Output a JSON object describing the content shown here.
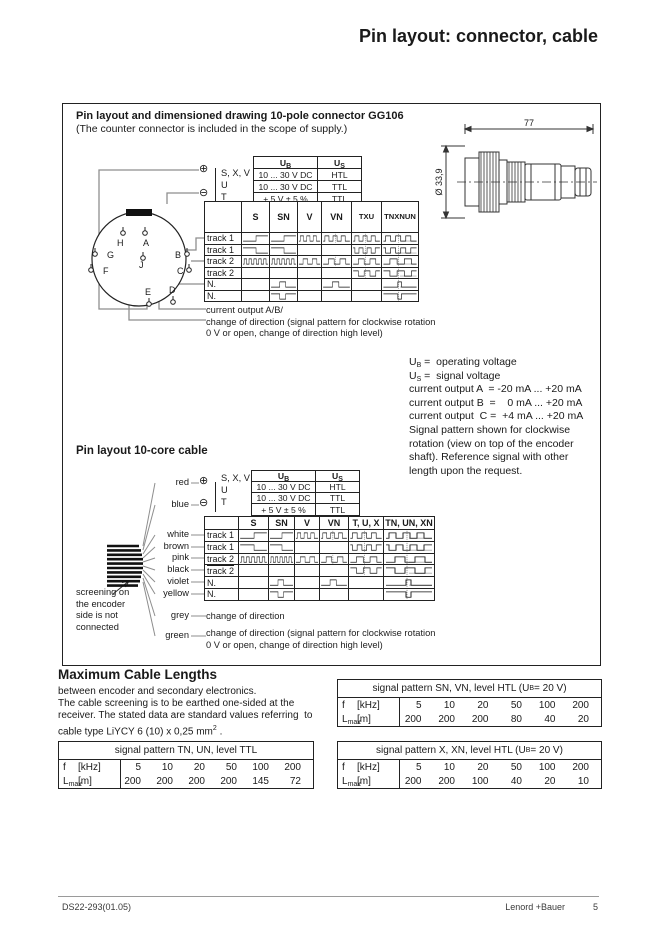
{
  "title": "Pin layout: connector, cable",
  "connector": {
    "heading": "Pin layout and dimensioned drawing 10-pole connector GG106",
    "subheading": "(The counter connector is included in the scope of supply.)",
    "dim_length": "77",
    "dim_diameter": "Ø 33,9",
    "pins": [
      "H",
      "A",
      "G",
      "B",
      "F",
      "C",
      "E",
      "D",
      "J"
    ],
    "terminal_plus": "⊕",
    "terminal_minus": "⊖",
    "power_labels": [
      "S, X, V",
      "U",
      "T"
    ],
    "power_header": [
      {
        "pre": "U",
        "sub": "B"
      },
      {
        "pre": "U",
        "sub": "S"
      }
    ],
    "power_rows": [
      [
        "10 ... 30 V DC",
        "HTL"
      ],
      [
        "10 ... 30 V DC",
        "TTL"
      ],
      [
        "+ 5 V ± 5 %",
        "TTL"
      ]
    ],
    "signal_columns": [
      "S",
      "SN",
      "V",
      "VN",
      [
        "T",
        "X",
        "U"
      ],
      [
        "TN",
        "XN",
        "UN"
      ]
    ],
    "signal_rows": [
      {
        "label": "track 1",
        "over": false,
        "waves": [
          "rise",
          "rise",
          "sq3",
          "sq3 d",
          "sq3 d",
          "sq3 d g"
        ]
      },
      {
        "label": "track 1",
        "over": true,
        "waves": [
          "fall",
          "fall",
          "",
          "",
          "sq3i d",
          "sq3i d g"
        ]
      },
      {
        "label": "track 2",
        "over": false,
        "waves": [
          "sq5",
          "sq5",
          "sq2",
          "sq2 d",
          "sq2 d",
          "sq2 d g"
        ]
      },
      {
        "label": "track 2",
        "over": true,
        "waves": [
          "",
          "",
          "",
          "",
          "sq2i d",
          "sq2i d g"
        ]
      },
      {
        "label": "N.",
        "over": false,
        "waves": [
          "",
          "pulse",
          "",
          "pulse",
          "",
          "npulse d g"
        ]
      },
      {
        "label": "N.",
        "over": true,
        "waves": [
          "",
          "pulsei",
          "",
          "",
          "",
          "npulsei d"
        ]
      }
    ],
    "notes": [
      "current output A/B/",
      "change of direction (signal pattern for clockwise rotation",
      "0 V or open, change of direction high level)"
    ]
  },
  "legend": {
    "lines": [
      {
        "pre": "U",
        "sub": "B",
        "text": " =  operating voltage"
      },
      {
        "pre": "U",
        "sub": "S",
        "text": " =  signal voltage"
      },
      {
        "text": "current output A  = -20 mA ... +20 mA"
      },
      {
        "text": "current output B  =    0 mA ... +20 mA"
      },
      {
        "text": "current output  C =  +4 mA ... +20 mA"
      },
      {
        "text": "Signal pattern shown for clockwise"
      },
      {
        "text": "rotation (view on top of the encoder"
      },
      {
        "text": "shaft). Reference signal with other"
      },
      {
        "text": "length upon the request."
      }
    ]
  },
  "cable": {
    "heading": "Pin layout 10-core cable",
    "terminal_plus": "⊕",
    "terminal_minus": "⊖",
    "power_labels": [
      "S, X, V",
      "U",
      "T"
    ],
    "power_header": [
      {
        "pre": "U",
        "sub": "B"
      },
      {
        "pre": "U",
        "sub": "S"
      }
    ],
    "power_rows": [
      [
        "10 ... 30 V DC",
        "HTL"
      ],
      [
        "10 ... 30 V DC",
        "TTL"
      ],
      [
        "+ 5 V ± 5 %",
        "TTL"
      ]
    ],
    "wires": [
      "red",
      "blue",
      "white",
      "brown",
      "pink",
      "black",
      "violet",
      "yellow",
      "grey",
      "green"
    ],
    "signal_columns": [
      "S",
      "SN",
      "V",
      "VN",
      "T, U, X",
      "TN, UN, XN"
    ],
    "signal_rows": [
      {
        "label": "track 1",
        "over": false,
        "waves": [
          "rise",
          "rise",
          "sq3",
          "sq3 d",
          "sq3 d",
          "sq3 d g"
        ]
      },
      {
        "label": "track 1",
        "over": true,
        "waves": [
          "fall",
          "fall",
          "",
          "",
          "sq3i d",
          "sq3i d g"
        ]
      },
      {
        "label": "track 2",
        "over": false,
        "waves": [
          "sq5",
          "sq5",
          "sq2",
          "sq2 d",
          "sq2 d",
          "sq2 d g"
        ]
      },
      {
        "label": "track 2",
        "over": true,
        "waves": [
          "",
          "",
          "",
          "",
          "sq2i d",
          "sq2i d g"
        ]
      },
      {
        "label": "N.",
        "over": false,
        "waves": [
          "",
          "pulse",
          "",
          "pulse",
          "",
          "npulse d g"
        ]
      },
      {
        "label": "N.",
        "over": true,
        "waves": [
          "",
          "pulsei",
          "",
          "",
          "",
          "npulsei d"
        ]
      }
    ],
    "screening_note": [
      "screening on",
      "the encoder",
      "side is not",
      "connected"
    ],
    "notes": [
      "change of direction",
      "change of direction (signal pattern for clockwise rotation",
      "0 V or open, change of direction high level)"
    ]
  },
  "max_lengths": {
    "heading": "Maximum Cable Lengths",
    "paragraph": [
      {
        "t": "between encoder and secondary electronics."
      },
      {
        "t": "The cable screening is to be earthed one-sided at the"
      },
      {
        "t": "receiver. The stated data are standard values referring  to"
      },
      {
        "t": "cable type LiYCY 6 (10) x 0,25 mm",
        "sup": "2",
        "tail": " ."
      }
    ],
    "tables": [
      {
        "title": [
          {
            "t": "signal pattern TN, UN, level TTL"
          }
        ],
        "f_sym": "f",
        "f_unit": "[kHz]",
        "l_sym": "L",
        "l_sub": "max",
        "l_unit": "[m]",
        "f": [
          "5",
          "10",
          "20",
          "50",
          "100",
          "200"
        ],
        "l": [
          "200",
          "200",
          "200",
          "200",
          "145",
          "72"
        ]
      },
      {
        "title": [
          {
            "t": "signal pattern SN, VN, level HTL (U"
          },
          {
            "sub": "B"
          },
          {
            "t": "= 20 V)"
          }
        ],
        "f_sym": "f",
        "f_unit": "[kHz]",
        "l_sym": "L",
        "l_sub": "max",
        "l_unit": "[m]",
        "f": [
          "5",
          "10",
          "20",
          "50",
          "100",
          "200"
        ],
        "l": [
          "200",
          "200",
          "200",
          "80",
          "40",
          "20"
        ]
      },
      {
        "title": [
          {
            "t": "signal pattern X, XN, level HTL (U"
          },
          {
            "sub": "B"
          },
          {
            "t": "= 20 V)"
          }
        ],
        "f_sym": "f",
        "f_unit": "[kHz]",
        "l_sym": "L",
        "l_sub": "max",
        "l_unit": "[m]",
        "f": [
          "5",
          "10",
          "20",
          "50",
          "100",
          "200"
        ],
        "l": [
          "200",
          "200",
          "100",
          "40",
          "20",
          "10"
        ]
      }
    ]
  },
  "footer": {
    "doc_number": "DS22-293(01.05)",
    "brand": "Lenord +Bauer",
    "page": "5"
  }
}
